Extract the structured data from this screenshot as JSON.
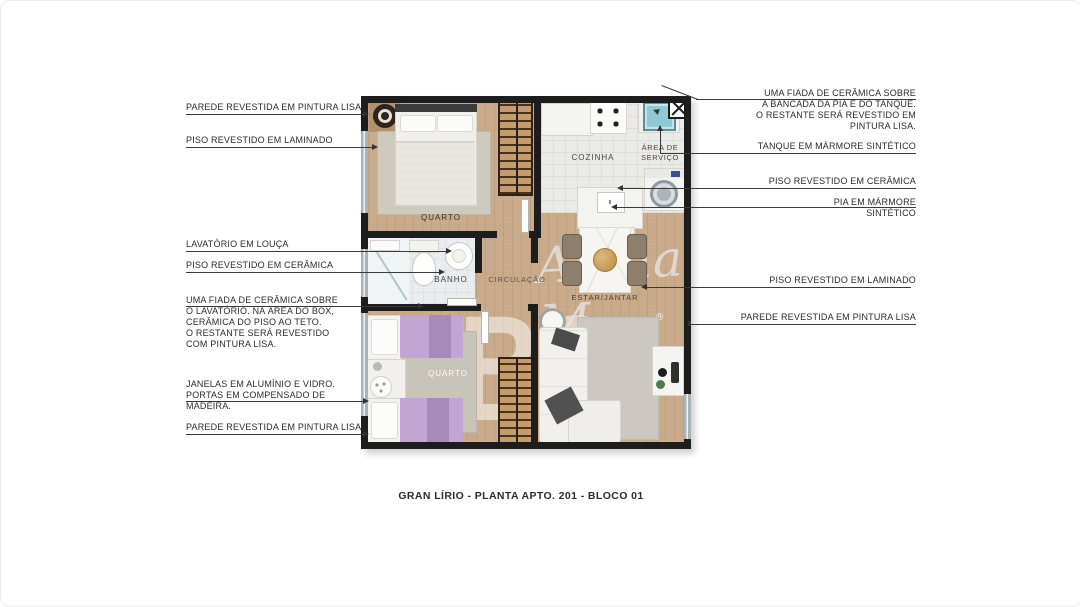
{
  "title": {
    "caption": "GRAN LÍRIO - PLANTA APTO. 201 - BLOCO 01"
  },
  "watermark": {
    "logo": "TBS",
    "registered": "®",
    "script": "Alpha M"
  },
  "rooms": {
    "quarto1": "QUARTO",
    "cozinha": "COZINHA",
    "area_servico": {
      "lines": [
        "ÁREA DE",
        "SERVIÇO"
      ]
    },
    "banho": "BANHO",
    "circulacao": "CIRCULAÇÃO",
    "estar_jantar": "ESTAR/JANTAR",
    "quarto2": "QUARTO"
  },
  "annotations": {
    "left": [
      {
        "id": "parede-pintura-lisa-top",
        "lines": [
          "PAREDE REVESTIDA EM PINTURA LISA"
        ]
      },
      {
        "id": "piso-laminado",
        "lines": [
          "PISO REVESTIDO EM LAMINADO"
        ]
      },
      {
        "id": "lavatorio-louca",
        "lines": [
          "LAVATÓRIO EM LOUÇA"
        ]
      },
      {
        "id": "piso-ceramica-banho",
        "lines": [
          "PISO REVESTIDO EM CERÂMICA"
        ]
      },
      {
        "id": "fiada-ceramica-banho",
        "lines": [
          "UMA FIADA DE CERÂMICA SOBRE",
          "O LAVATÓRIO. NA ÁREA DO BOX,",
          "CERÂMICA DO PISO AO TETO.",
          "O RESTANTE SERÁ REVESTIDO",
          "COM PINTURA LISA."
        ]
      },
      {
        "id": "janelas-portas",
        "lines": [
          "JANELAS EM ALUMÍNIO E VIDRO.",
          "PORTAS EM COMPENSADO DE",
          "MADEIRA."
        ]
      },
      {
        "id": "parede-pintura-lisa-bottom",
        "lines": [
          "PAREDE REVESTIDA EM PINTURA LISA"
        ]
      }
    ],
    "right": [
      {
        "id": "fiada-ceramica-cozinha",
        "lines": [
          "UMA FIADA DE CERÂMICA SOBRE",
          "A BANCADA DA PIA E DO TANQUE.",
          "O RESTANTE SERÁ REVESTIDO EM",
          "PINTURA LISA."
        ]
      },
      {
        "id": "tanque-marmore",
        "lines": [
          "TANQUE EM MÁRMORE SINTÉTICO"
        ]
      },
      {
        "id": "piso-ceramica-cozinha",
        "lines": [
          "PISO REVESTIDO EM CERÂMICA"
        ]
      },
      {
        "id": "pia-marmore",
        "lines": [
          "PIA EM MÁRMORE",
          "SINTÉTICO"
        ]
      },
      {
        "id": "piso-laminado-estar",
        "lines": [
          "PISO REVESTIDO EM LAMINADO"
        ]
      },
      {
        "id": "parede-pintura-lisa-right",
        "lines": [
          "PAREDE REVESTIDA EM PINTURA LISA"
        ]
      }
    ]
  },
  "colors": {
    "wall": "#1d1d1d",
    "wood_floor": "#c9ab8c",
    "tile_floor": "#eaeae8",
    "window": "#a7b4b9",
    "lilac_bed": "#c2a5d2",
    "tank_teal": "#8fc9d4",
    "leader_line": "#3a3a3a"
  }
}
